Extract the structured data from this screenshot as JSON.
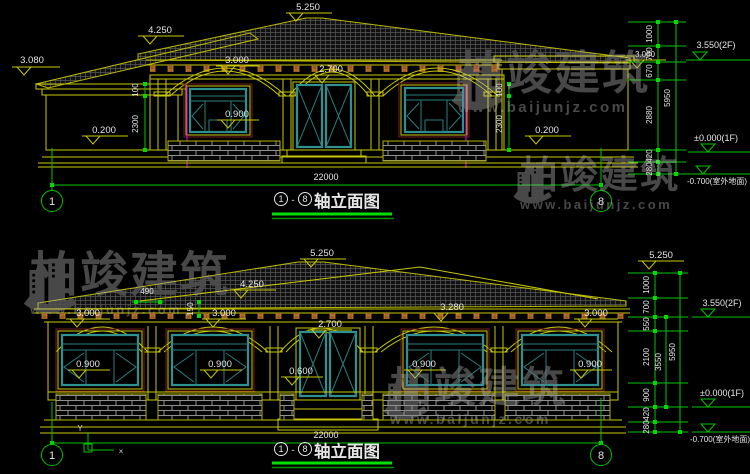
{
  "watermark": {
    "brand": "柏竣建筑",
    "url": "www.baijunjz.com"
  },
  "axes": {
    "start": "1",
    "end": "8"
  },
  "title": {
    "name": "轴立面图",
    "dash": "-"
  },
  "d1": {
    "ridge": "5.250",
    "slope": "4.250",
    "eave_left": "3.080",
    "eave_right": "3.080",
    "arch_window": "3.000",
    "arch_door": "2.700",
    "sill": "0.900",
    "base_left": "0.200",
    "base_right": "0.200",
    "vdim_upper": "100",
    "vdim_lower": "2300",
    "overall": "22000",
    "segments": [
      "1000",
      "700",
      "670",
      "2880",
      "420",
      "280"
    ],
    "total": "5950",
    "level_2f": "3.550(2F)",
    "level_1f": "±0.000(1F)",
    "level_ground": "-0.700(室外地面)"
  },
  "d2": {
    "ridge": "5.250",
    "slope": "4.250",
    "dim_overhang": "490",
    "dim_rise": "150",
    "arches": [
      "3.000",
      "3.000",
      "2.700",
      "3.280",
      "3.000"
    ],
    "sills": [
      "0.900",
      "0.900",
      "0.600",
      "0.900",
      "0.900"
    ],
    "overall": "22000",
    "segments": [
      "1000",
      "700",
      "550",
      "2100",
      "900",
      "420",
      "280"
    ],
    "sub_total": "3550",
    "total": "5950",
    "ridge_level": "5.250",
    "level_2f": "3.550(2F)",
    "level_1f": "±0.000(1F)",
    "level_ground": "-0.700(室外地面)",
    "ucs_y": "Y",
    "ucs_x": "×"
  }
}
